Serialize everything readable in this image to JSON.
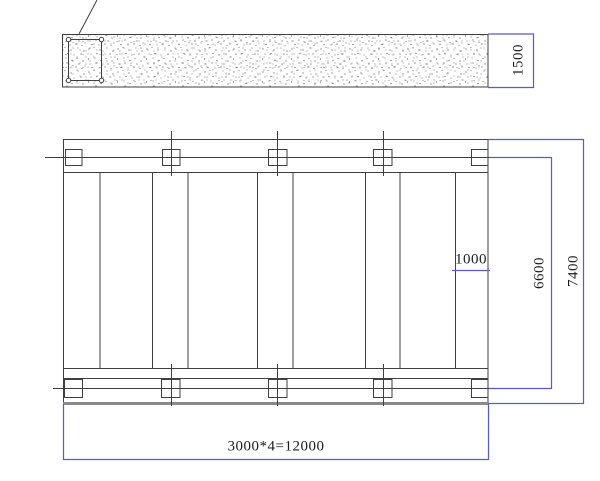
{
  "drawing": {
    "type": "structural-plan-and-section",
    "section_view": {
      "depth_dim": "1500"
    },
    "plan_view": {
      "slab_width_dim": "1000",
      "inner_span_dim": "6600",
      "overall_span_dim": "7400",
      "bay_total_dim": "3000*4=12000"
    },
    "colors": {
      "dimension_blue": "#5a5ad0",
      "line_dark": "#3f3f3f",
      "thick_edge_gray": "#8a8a8a"
    }
  }
}
